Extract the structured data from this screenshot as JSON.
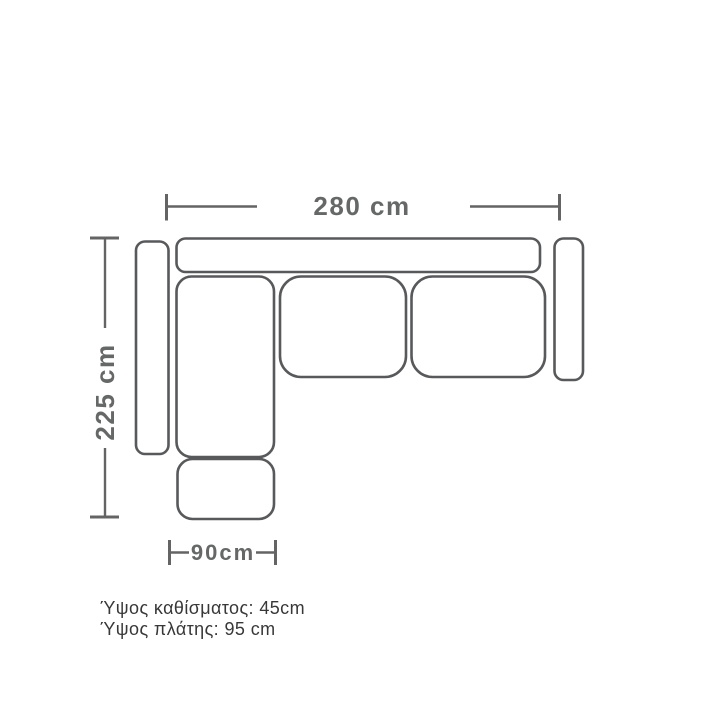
{
  "diagram": {
    "labels": {
      "width": "280 cm",
      "depth": "225 cm",
      "chaise_width": "90cm"
    },
    "notes": {
      "seat_height": "Ύψος καθίσματος: 45cm",
      "back_height": "Ύψος πλάτης: 95 cm"
    },
    "colors": {
      "background": "#ffffff",
      "sofa_outline": "#58595b",
      "dimension_lines": "#646464",
      "dimension_text": "#666868",
      "note_text": "#383838"
    }
  }
}
